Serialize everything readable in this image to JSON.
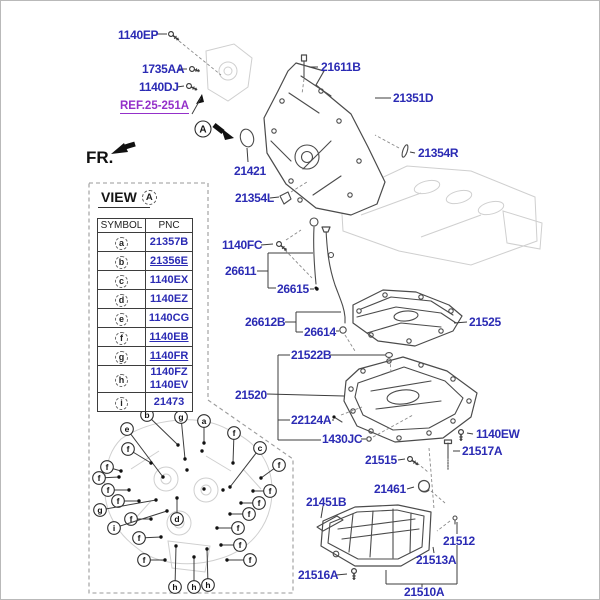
{
  "frame": {
    "fr_label": "FR."
  },
  "ref_callout": {
    "text": "REF.25-251A"
  },
  "detail_marker": {
    "symbol": "A"
  },
  "view_panel": {
    "title": "VIEW",
    "symbol": "A"
  },
  "colors": {
    "part_label": "#2b2bb4",
    "ref_label": "#9430c9",
    "line_ink": "#4b4b4b"
  },
  "table": {
    "headers": [
      "SYMBOL",
      "PNC"
    ],
    "rows": [
      {
        "symbol": "a",
        "pnc": [
          "21357B"
        ],
        "underline": false
      },
      {
        "symbol": "b",
        "pnc": [
          "21356E"
        ],
        "underline": true
      },
      {
        "symbol": "c",
        "pnc": [
          "1140EX"
        ],
        "underline": false
      },
      {
        "symbol": "d",
        "pnc": [
          "1140EZ"
        ],
        "underline": false
      },
      {
        "symbol": "e",
        "pnc": [
          "1140CG"
        ],
        "underline": false
      },
      {
        "symbol": "f",
        "pnc": [
          "1140EB"
        ],
        "underline": true
      },
      {
        "symbol": "g",
        "pnc": [
          "1140FR"
        ],
        "underline": true
      },
      {
        "symbol": "h",
        "pnc": [
          "1140FZ",
          "1140EV"
        ],
        "underline": false
      },
      {
        "symbol": "i",
        "pnc": [
          "21473"
        ],
        "underline": false
      }
    ]
  },
  "callouts": [
    {
      "text": "1140EP",
      "x": 117,
      "y": 27
    },
    {
      "text": "1735AA",
      "x": 141,
      "y": 61
    },
    {
      "text": "1140DJ",
      "x": 138,
      "y": 79
    },
    {
      "text": "21611B",
      "x": 320,
      "y": 59
    },
    {
      "text": "21351D",
      "x": 392,
      "y": 90
    },
    {
      "text": "21421",
      "x": 233,
      "y": 163
    },
    {
      "text": "21354L",
      "x": 234,
      "y": 190
    },
    {
      "text": "21354R",
      "x": 417,
      "y": 145
    },
    {
      "text": "1140FC",
      "x": 221,
      "y": 237
    },
    {
      "text": "26611",
      "x": 224,
      "y": 263
    },
    {
      "text": "26615",
      "x": 276,
      "y": 281
    },
    {
      "text": "26612B",
      "x": 244,
      "y": 314
    },
    {
      "text": "26614",
      "x": 303,
      "y": 324
    },
    {
      "text": "21525",
      "x": 468,
      "y": 314
    },
    {
      "text": "21522B",
      "x": 290,
      "y": 347
    },
    {
      "text": "21520",
      "x": 234,
      "y": 387
    },
    {
      "text": "22124A",
      "x": 290,
      "y": 412
    },
    {
      "text": "1430JC",
      "x": 321,
      "y": 431
    },
    {
      "text": "1140EW",
      "x": 475,
      "y": 426
    },
    {
      "text": "21517A",
      "x": 461,
      "y": 443
    },
    {
      "text": "21515",
      "x": 364,
      "y": 452
    },
    {
      "text": "21461",
      "x": 373,
      "y": 481
    },
    {
      "text": "21451B",
      "x": 305,
      "y": 494
    },
    {
      "text": "21512",
      "x": 442,
      "y": 533
    },
    {
      "text": "21513A",
      "x": 415,
      "y": 552
    },
    {
      "text": "21516A",
      "x": 297,
      "y": 567
    },
    {
      "text": "21510A",
      "x": 403,
      "y": 584
    }
  ],
  "diagram": {
    "leaders": [
      [
        155,
        33,
        166,
        33
      ],
      [
        178,
        68,
        186,
        68
      ],
      [
        176,
        86,
        183,
        85
      ],
      [
        317,
        66,
        308,
        66
      ],
      [
        390,
        97,
        374,
        97
      ],
      [
        247,
        161,
        246,
        147
      ],
      [
        269,
        197,
        278,
        196
      ],
      [
        414,
        152,
        409,
        151
      ],
      [
        260,
        244,
        272,
        243
      ],
      [
        256,
        270,
        267,
        270
      ],
      [
        267,
        252,
        267,
        287
      ],
      [
        267,
        252,
        312,
        252
      ],
      [
        267,
        287,
        275,
        287
      ],
      [
        309,
        288,
        313,
        288
      ],
      [
        284,
        321,
        295,
        321
      ],
      [
        295,
        311,
        295,
        331
      ],
      [
        295,
        311,
        340,
        311
      ],
      [
        295,
        331,
        302,
        331
      ],
      [
        335,
        330,
        338,
        330
      ],
      [
        466,
        321,
        453,
        322
      ],
      [
        277,
        354,
        289,
        354
      ],
      [
        329,
        354,
        384,
        354
      ],
      [
        266,
        393,
        343,
        395
      ],
      [
        277,
        354,
        277,
        439
      ],
      [
        277,
        419,
        289,
        419
      ],
      [
        331,
        419,
        333,
        419
      ],
      [
        277,
        439,
        320,
        439
      ],
      [
        360,
        438,
        365,
        438
      ],
      [
        472,
        433,
        466,
        432
      ],
      [
        459,
        450,
        452,
        450
      ],
      [
        397,
        459,
        404,
        458
      ],
      [
        406,
        488,
        413,
        486
      ],
      [
        322,
        505,
        320,
        517
      ],
      [
        456,
        533,
        456,
        521
      ],
      [
        456,
        544,
        456,
        583
      ],
      [
        433,
        552,
        432,
        546
      ],
      [
        335,
        574,
        346,
        573
      ],
      [
        385,
        583,
        456,
        583
      ],
      [
        385,
        583,
        385,
        569
      ],
      [
        421,
        583,
        421,
        586
      ],
      [
        191,
        113,
        200,
        97
      ]
    ],
    "dashed": [
      [
        178,
        40,
        220,
        74
      ],
      [
        303,
        78,
        301,
        93
      ],
      [
        290,
        191,
        306,
        181
      ],
      [
        398,
        147,
        374,
        134
      ],
      [
        285,
        239,
        300,
        229
      ],
      [
        284,
        249,
        311,
        277
      ],
      [
        344,
        334,
        354,
        350
      ],
      [
        389,
        358,
        390,
        372
      ],
      [
        340,
        414,
        361,
        406
      ],
      [
        372,
        436,
        412,
        414
      ],
      [
        416,
        462,
        427,
        471
      ],
      [
        428,
        447,
        433,
        508
      ],
      [
        430,
        490,
        444,
        502
      ],
      [
        449,
        520,
        436,
        530
      ]
    ],
    "bolts": [
      [
        170,
        33,
        38,
        10
      ],
      [
        191,
        68,
        15,
        8
      ],
      [
        188,
        85,
        25,
        9
      ],
      [
        278,
        243,
        40,
        10
      ],
      [
        409,
        458,
        35,
        10
      ],
      [
        460,
        431,
        90,
        9
      ],
      [
        353,
        570,
        90,
        9
      ]
    ],
    "view_markers": [
      [
        "b",
        146,
        414,
        177,
        444
      ],
      [
        "g",
        180,
        416,
        184,
        458
      ],
      [
        "a",
        203,
        420,
        203,
        442
      ],
      [
        "e",
        126,
        428,
        162,
        476
      ],
      [
        "f",
        233,
        432,
        232,
        462
      ],
      [
        "f",
        127,
        448,
        150,
        462
      ],
      [
        "c",
        259,
        447,
        229,
        486
      ],
      [
        "f",
        106,
        466,
        120,
        470
      ],
      [
        "f",
        278,
        464,
        260,
        477
      ],
      [
        "f",
        98,
        477,
        118,
        476
      ],
      [
        "f",
        107,
        489,
        128,
        489
      ],
      [
        "f",
        269,
        490,
        252,
        490
      ],
      [
        "f",
        117,
        500,
        138,
        500
      ],
      [
        "f",
        258,
        502,
        240,
        502
      ],
      [
        "g",
        99,
        509,
        155,
        499
      ],
      [
        "f",
        130,
        518,
        150,
        518
      ],
      [
        "d",
        176,
        518,
        176,
        497
      ],
      [
        "f",
        248,
        513,
        229,
        513
      ],
      [
        "i",
        113,
        527,
        166,
        510
      ],
      [
        "f",
        237,
        527,
        216,
        527
      ],
      [
        "f",
        138,
        537,
        160,
        536
      ],
      [
        "f",
        239,
        544,
        220,
        544
      ],
      [
        "f",
        143,
        559,
        164,
        559
      ],
      [
        "f",
        249,
        559,
        226,
        559
      ],
      [
        "h",
        174,
        586,
        175,
        545
      ],
      [
        "h",
        193,
        586,
        193,
        556
      ],
      [
        "h",
        207,
        584,
        206,
        548
      ]
    ],
    "extra_dots": [
      [
        201,
        450
      ],
      [
        186,
        469
      ],
      [
        203,
        488
      ],
      [
        222,
        489
      ]
    ]
  }
}
